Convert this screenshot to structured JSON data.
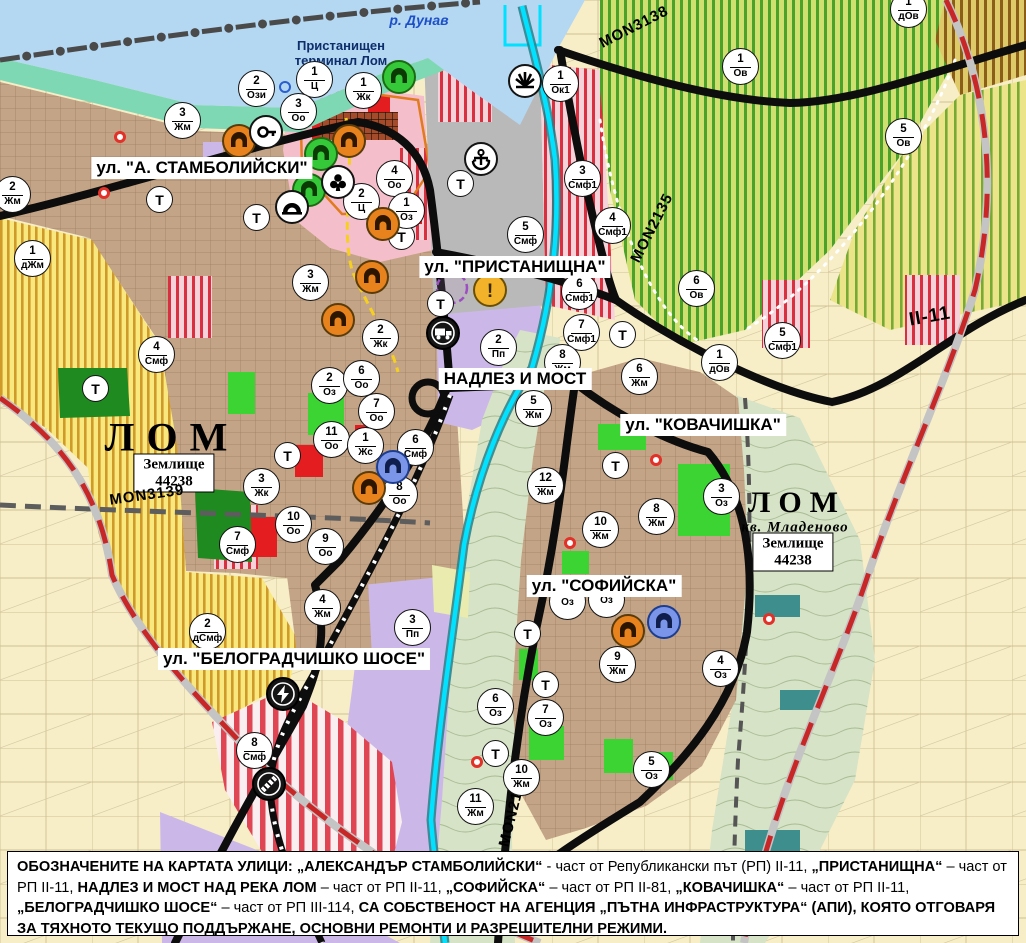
{
  "map": {
    "river_label": "р. Дунав",
    "port_label": {
      "line1": "Пристанищен",
      "line2": "терминал Лом"
    },
    "t_label": "Т",
    "street_labels": [
      {
        "text": "ул. \"А. СТАМБОЛИЙСКИ\"",
        "x": 202,
        "y": 168
      },
      {
        "text": "ул. \"ПРИСТАНИЩНА\"",
        "x": 515,
        "y": 267
      },
      {
        "text": "НАДЛЕЗ И МОСТ",
        "x": 515,
        "y": 379
      },
      {
        "text": "ул. \"КОВАЧИШКА\"",
        "x": 703,
        "y": 425
      },
      {
        "text": "ул. \"СОФИЙСКА\"",
        "x": 604,
        "y": 586
      },
      {
        "text": "ул. \"БЕЛОГРАДЧИШКО ШОСЕ\"",
        "x": 294,
        "y": 659
      }
    ],
    "road_labels": [
      {
        "text": "MON3139",
        "x": 147,
        "y": 495,
        "rot": -8,
        "big": false
      },
      {
        "text": "MON3138",
        "x": 634,
        "y": 27,
        "rot": -27,
        "big": false
      },
      {
        "text": "MON2135",
        "x": 652,
        "y": 228,
        "rot": -63,
        "big": false
      },
      {
        "text": "MON2136",
        "x": 513,
        "y": 810,
        "rot": -76,
        "big": false
      },
      {
        "text": "II-11",
        "x": 930,
        "y": 317,
        "rot": -10,
        "big": true
      }
    ],
    "area_labels": [
      {
        "text": "ЛОМ",
        "x": 172,
        "y": 437,
        "kind": "city-lg"
      },
      {
        "text": "ЛОМ",
        "x": 797,
        "y": 503,
        "kind": "city-sm"
      },
      {
        "text": "кв. Младеново",
        "x": 795,
        "y": 528,
        "kind": "district"
      }
    ],
    "land_boxes": [
      {
        "line1": "Землище",
        "line2": "44238",
        "x": 174,
        "y": 473
      },
      {
        "line1": "Землище",
        "line2": "44238",
        "x": 793,
        "y": 552
      }
    ],
    "zone_markers": [
      {
        "n": "2",
        "c": "Ози",
        "x": 257,
        "y": 89
      },
      {
        "n": "1",
        "c": "Ц",
        "x": 315,
        "y": 80
      },
      {
        "n": "1",
        "c": "Жк",
        "x": 364,
        "y": 91
      },
      {
        "n": "3",
        "c": "Оо",
        "x": 299,
        "y": 112
      },
      {
        "n": "3",
        "c": "Жм",
        "x": 183,
        "y": 121
      },
      {
        "n": "2",
        "c": "Жм",
        "x": 13,
        "y": 195
      },
      {
        "n": "4",
        "c": "Оо",
        "x": 395,
        "y": 179
      },
      {
        "n": "2",
        "c": "Ц",
        "x": 362,
        "y": 202
      },
      {
        "n": "1",
        "c": "Оз",
        "x": 407,
        "y": 211
      },
      {
        "n": "1",
        "c": "дЖм",
        "x": 33,
        "y": 259
      },
      {
        "n": "4",
        "c": "Смф",
        "x": 157,
        "y": 355
      },
      {
        "n": "3",
        "c": "Жм",
        "x": 311,
        "y": 283
      },
      {
        "n": "2",
        "c": "Жк",
        "x": 381,
        "y": 338
      },
      {
        "n": "2",
        "c": "Оз",
        "x": 330,
        "y": 386
      },
      {
        "n": "6",
        "c": "Оо",
        "x": 362,
        "y": 379
      },
      {
        "n": "7",
        "c": "Оо",
        "x": 377,
        "y": 412
      },
      {
        "n": "11",
        "c": "Оо",
        "x": 332,
        "y": 440
      },
      {
        "n": "1",
        "c": "Жс",
        "x": 366,
        "y": 446
      },
      {
        "n": "6",
        "c": "Смф",
        "x": 416,
        "y": 448
      },
      {
        "n": "8",
        "c": "Оо",
        "x": 400,
        "y": 495
      },
      {
        "n": "3",
        "c": "Жк",
        "x": 262,
        "y": 487
      },
      {
        "n": "10",
        "c": "Оо",
        "x": 294,
        "y": 525
      },
      {
        "n": "9",
        "c": "Оо",
        "x": 326,
        "y": 547
      },
      {
        "n": "7",
        "c": "Смф",
        "x": 238,
        "y": 545
      },
      {
        "n": "2",
        "c": "дСмф",
        "x": 208,
        "y": 632
      },
      {
        "n": "4",
        "c": "Жм",
        "x": 323,
        "y": 608
      },
      {
        "n": "3",
        "c": "Пп",
        "x": 413,
        "y": 628
      },
      {
        "n": "8",
        "c": "Смф",
        "x": 255,
        "y": 751
      },
      {
        "n": "1",
        "c": "Ок1",
        "x": 561,
        "y": 84
      },
      {
        "n": "1",
        "c": "Ов",
        "x": 741,
        "y": 67
      },
      {
        "n": "1",
        "c": "дОв",
        "x": 909,
        "y": 10
      },
      {
        "n": "5",
        "c": "Ов",
        "x": 904,
        "y": 137
      },
      {
        "n": "3",
        "c": "Смф1",
        "x": 583,
        "y": 179
      },
      {
        "n": "4",
        "c": "Смф1",
        "x": 613,
        "y": 226
      },
      {
        "n": "5",
        "c": "Смф",
        "x": 526,
        "y": 235
      },
      {
        "n": "6",
        "c": "Смф1",
        "x": 580,
        "y": 292
      },
      {
        "n": "7",
        "c": "Смф1",
        "x": 582,
        "y": 333
      },
      {
        "n": "2",
        "c": "Пп",
        "x": 499,
        "y": 348
      },
      {
        "n": "8",
        "c": "Жм",
        "x": 563,
        "y": 363
      },
      {
        "n": "6",
        "c": "Ов",
        "x": 697,
        "y": 289
      },
      {
        "n": "1",
        "c": "дОв",
        "x": 720,
        "y": 363
      },
      {
        "n": "5",
        "c": "Смф1",
        "x": 783,
        "y": 341
      },
      {
        "n": "6",
        "c": "Жм",
        "x": 640,
        "y": 377
      },
      {
        "n": "5",
        "c": "Жм",
        "x": 534,
        "y": 409
      },
      {
        "n": "12",
        "c": "Жм",
        "x": 546,
        "y": 486
      },
      {
        "n": "10",
        "c": "Жм",
        "x": 601,
        "y": 530
      },
      {
        "n": "8",
        "c": "Жм",
        "x": 657,
        "y": 517
      },
      {
        "n": "3",
        "c": "Оз",
        "x": 722,
        "y": 497
      },
      {
        "n": "",
        "c": "Оз",
        "x": 568,
        "y": 602
      },
      {
        "n": "",
        "c": "Оз",
        "x": 607,
        "y": 600
      },
      {
        "n": "9",
        "c": "Жм",
        "x": 618,
        "y": 665
      },
      {
        "n": "4",
        "c": "Оз",
        "x": 721,
        "y": 669
      },
      {
        "n": "6",
        "c": "Оз",
        "x": 496,
        "y": 707
      },
      {
        "n": "7",
        "c": "Оз",
        "x": 546,
        "y": 718
      },
      {
        "n": "5",
        "c": "Оз",
        "x": 652,
        "y": 770
      },
      {
        "n": "10",
        "c": "Жм",
        "x": 522,
        "y": 778
      },
      {
        "n": "11",
        "c": "Жм",
        "x": 476,
        "y": 807
      }
    ],
    "t_markers": [
      {
        "x": 160,
        "y": 200
      },
      {
        "x": 257,
        "y": 218
      },
      {
        "x": 402,
        "y": 237
      },
      {
        "x": 461,
        "y": 184
      },
      {
        "x": 96,
        "y": 389
      },
      {
        "x": 288,
        "y": 456
      },
      {
        "x": 441,
        "y": 304
      },
      {
        "x": 623,
        "y": 335
      },
      {
        "x": 616,
        "y": 466
      },
      {
        "x": 528,
        "y": 634
      },
      {
        "x": 546,
        "y": 685
      },
      {
        "x": 496,
        "y": 754
      }
    ],
    "icon_markers": [
      {
        "type": "monument-orange",
        "x": 239,
        "y": 141
      },
      {
        "type": "monument-orange",
        "x": 349,
        "y": 141
      },
      {
        "type": "monument-orange",
        "x": 383,
        "y": 224
      },
      {
        "type": "monument-orange",
        "x": 372,
        "y": 277
      },
      {
        "type": "monument-orange",
        "x": 338,
        "y": 320
      },
      {
        "type": "monument-orange",
        "x": 369,
        "y": 488
      },
      {
        "type": "monument-orange",
        "x": 628,
        "y": 631
      },
      {
        "type": "monument-green",
        "x": 321,
        "y": 154
      },
      {
        "type": "monument-green",
        "x": 309,
        "y": 190
      },
      {
        "type": "monument-green",
        "x": 399,
        "y": 77
      },
      {
        "type": "monument-blue",
        "x": 393,
        "y": 467
      },
      {
        "type": "monument-blue",
        "x": 664,
        "y": 622
      },
      {
        "type": "key",
        "x": 266,
        "y": 132
      },
      {
        "type": "club",
        "x": 338,
        "y": 182
      },
      {
        "type": "tunnel",
        "x": 292,
        "y": 207
      },
      {
        "type": "anchor",
        "x": 481,
        "y": 159
      },
      {
        "type": "sun",
        "x": 525,
        "y": 81
      },
      {
        "type": "warning",
        "x": 490,
        "y": 290
      },
      {
        "type": "truck",
        "x": 443,
        "y": 333
      },
      {
        "type": "lightning",
        "x": 283,
        "y": 694
      },
      {
        "type": "railway-cross",
        "x": 269,
        "y": 784
      }
    ],
    "red_dots": [
      {
        "x": 120,
        "y": 137
      },
      {
        "x": 104,
        "y": 193
      },
      {
        "x": 656,
        "y": 460
      },
      {
        "x": 570,
        "y": 543
      },
      {
        "x": 769,
        "y": 619
      },
      {
        "x": 477,
        "y": 762
      }
    ],
    "blue_rings": [
      {
        "x": 285,
        "y": 87
      }
    ]
  },
  "colors": {
    "monument_orange_bg": "#e8821c",
    "monument_orange_ring": "#5a3c0a",
    "monument_green_bg": "#35c93a",
    "monument_green_ring": "#1c6b12",
    "monument_blue_bg": "#7b96e8",
    "monument_blue_ring": "#1d3d8f",
    "white_bg": "#ffffff",
    "white_ring": "#141414",
    "warning_bg": "#f2b32a",
    "warning_ring": "#6b4f00",
    "black_bg": "#151515",
    "black_ring": "#000000",
    "water": "#b4d7f2",
    "road_red": "#c82727",
    "street_black": "#0d0d0d",
    "channel_cyan": "#00e2ff"
  },
  "footer": {
    "segments": [
      {
        "t": "ОБОЗНАЧЕНИТЕ НА КАРТАТА УЛИЦИ: „АЛЕКСАНДЪР СТАМБОЛИЙСКИ“",
        "b": true
      },
      {
        "t": " - част от Републикански път (РП) II-11, ",
        "b": false
      },
      {
        "t": "„ПРИСТАНИЩНА“",
        "b": true
      },
      {
        "t": " – част от РП II-11, ",
        "b": false
      },
      {
        "t": "НАДЛЕЗ И МОСТ НАД РЕКА ЛОМ",
        "b": true
      },
      {
        "t": " – част от РП II-11, ",
        "b": false
      },
      {
        "t": "„СОФИЙСКА“",
        "b": true
      },
      {
        "t": " – част от РП II-81, ",
        "b": false
      },
      {
        "t": "„КОВАЧИШКА“",
        "b": true
      },
      {
        "t": " – част от РП II-11, ",
        "b": false
      },
      {
        "t": "„БЕЛОГРАДЧИШКО ШОСЕ“",
        "b": true
      },
      {
        "t": " – част от РП III-114, ",
        "b": false
      },
      {
        "t": "СА СОБСТВЕНОСТ НА АГЕНЦИЯ „ПЪТНА ИНФРАСТРУКТУРА“ (АПИ), КОЯТО ОТГОВАРЯ ЗА ТЯХНОТО ТЕКУЩО ПОДДЪРЖАНЕ, ОСНОВНИ РЕМОНТИ И РАЗРЕШИТЕЛНИ РЕЖИМИ.",
        "b": true
      }
    ]
  }
}
